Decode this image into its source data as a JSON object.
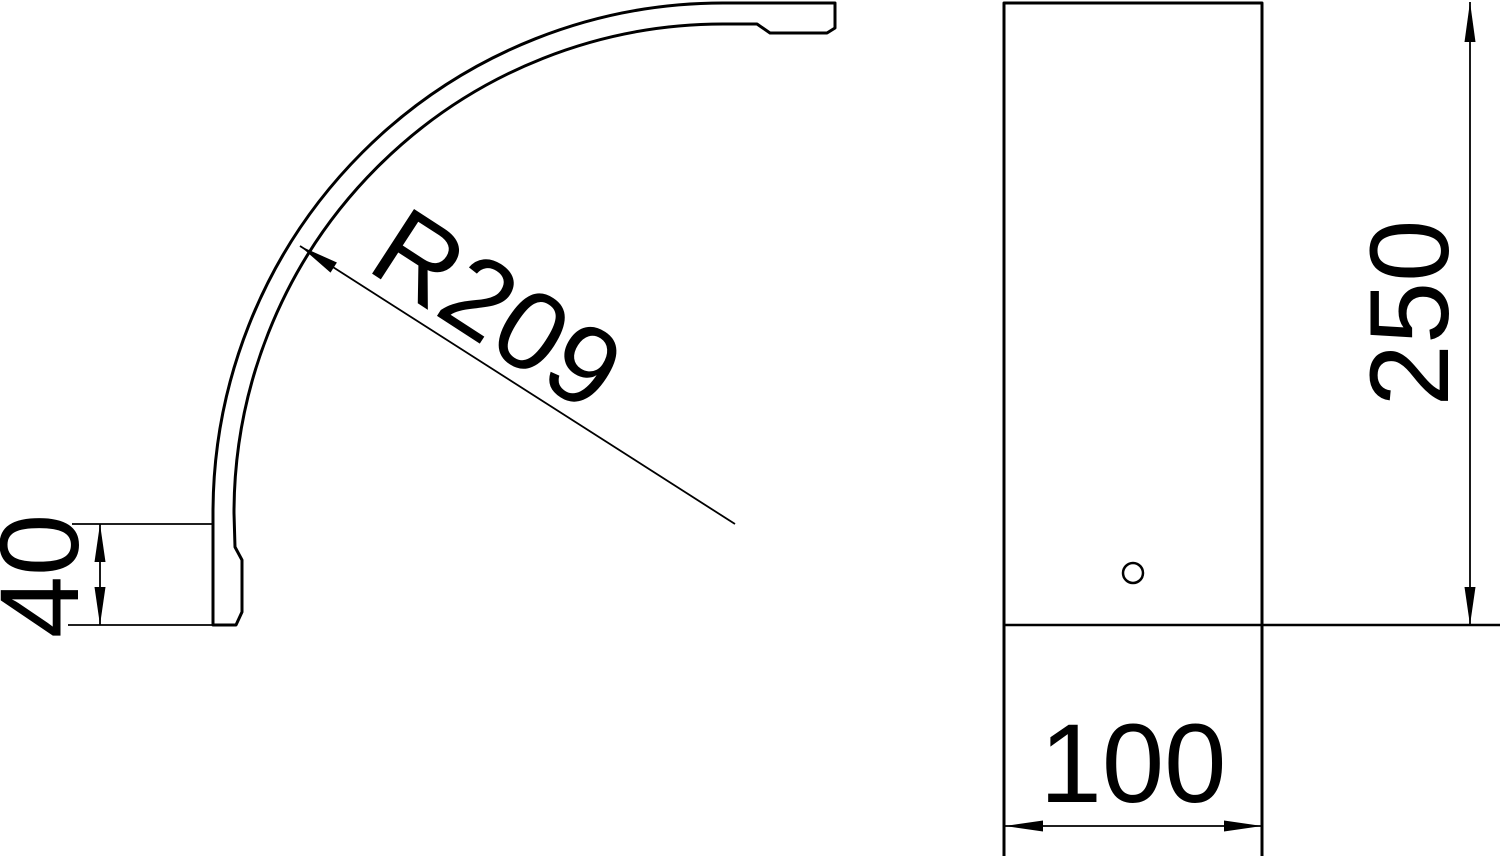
{
  "drawing": {
    "kind": "technical-drawing",
    "background_color": "#ffffff",
    "line_color": "#000000",
    "dimensions": {
      "radius": "R209",
      "profile_height": "40",
      "cover_length": "250",
      "cover_width": "100"
    }
  }
}
